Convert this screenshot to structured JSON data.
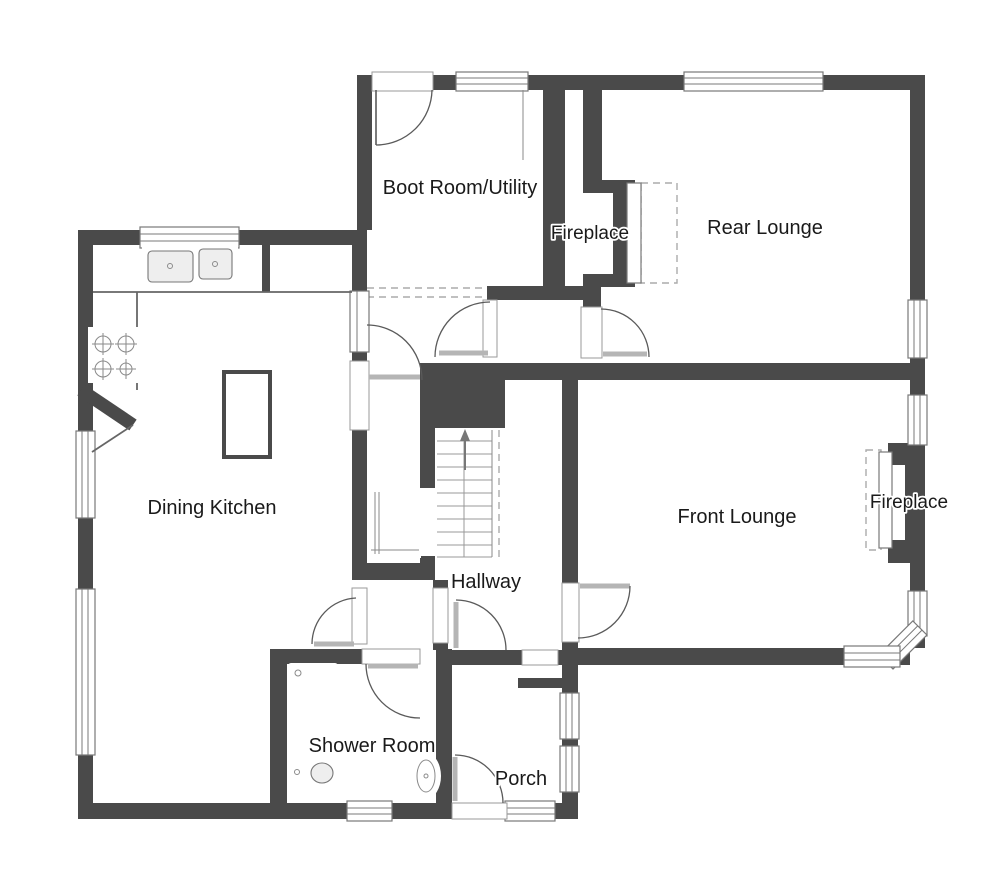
{
  "plan": {
    "type": "floor-plan",
    "colors": {
      "background": "#ffffff",
      "wall": "#4a4a4a",
      "frame": "#787878",
      "door": "#5a5a5a",
      "leaf": "#b5b5b5",
      "dash": "#ababab",
      "label": "#1a1a1a",
      "fixture": "#777777"
    },
    "rooms": [
      {
        "id": "boot-room-utility",
        "label": "Boot Room/Utility"
      },
      {
        "id": "rear-fireplace",
        "label": "Fireplace"
      },
      {
        "id": "rear-lounge",
        "label": "Rear Lounge"
      },
      {
        "id": "dining-kitchen",
        "label": "Dining Kitchen"
      },
      {
        "id": "hallway",
        "label": "Hallway"
      },
      {
        "id": "front-lounge",
        "label": "Front Lounge"
      },
      {
        "id": "front-fireplace",
        "label": "Fireplace"
      },
      {
        "id": "shower-room",
        "label": "Shower Room"
      },
      {
        "id": "porch",
        "label": "Porch"
      }
    ],
    "fixtures": [
      "kitchen-sink",
      "hob",
      "kitchen-island",
      "kitchen-counter",
      "appliance-unit",
      "stairs-up",
      "shower-tray",
      "toilet",
      "wash-basin",
      "rear-fireplace",
      "front-fireplace"
    ],
    "stairs_direction": "up"
  }
}
